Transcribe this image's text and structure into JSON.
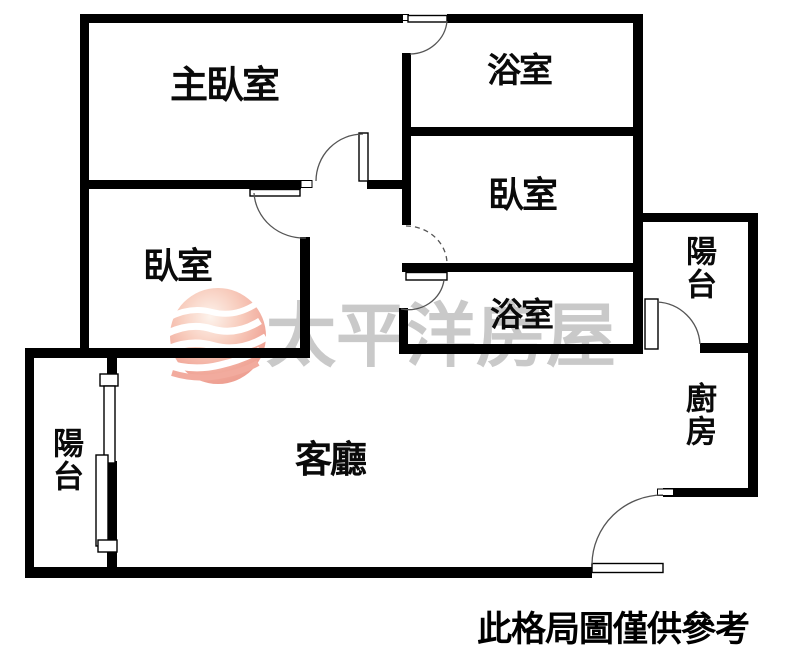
{
  "watermark": {
    "brand_text": "太平洋房屋",
    "logo": "pacific-sphere-waves-icon",
    "text_color": "#c9c9c9",
    "logo_color": "#f0a496"
  },
  "caption": {
    "text": "此格局圖僅供參考"
  },
  "rooms": {
    "master_bedroom": {
      "label": "主臥室"
    },
    "bathroom_top": {
      "label": "浴室"
    },
    "bedroom_right": {
      "label": "臥室"
    },
    "bedroom_left": {
      "label": "臥室"
    },
    "bathroom_middle": {
      "label": "浴室"
    },
    "balcony_right": {
      "label": "陽台"
    },
    "kitchen": {
      "label": "廚房"
    },
    "living_room": {
      "label": "客廳"
    },
    "balcony_left": {
      "label": "陽台"
    }
  },
  "colors": {
    "wall": "#000000",
    "door_line": "#555555",
    "background": "#ffffff"
  }
}
